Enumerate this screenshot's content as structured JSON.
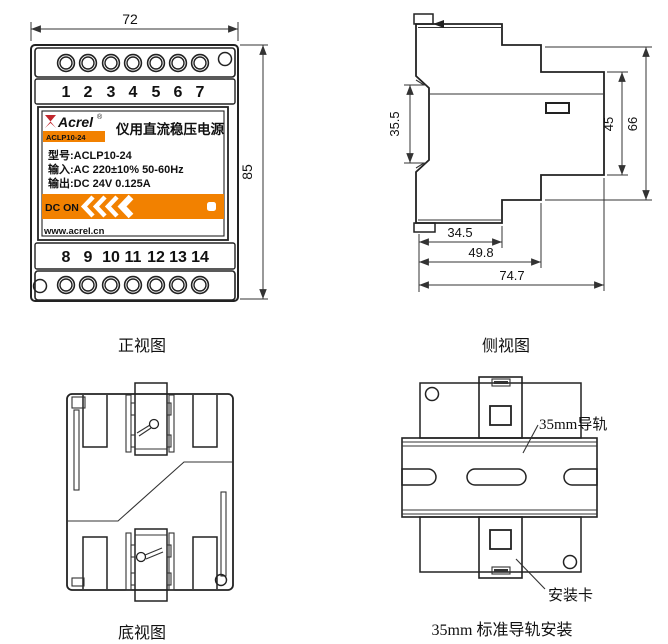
{
  "front": {
    "caption": "正视图",
    "dim_width": "72",
    "dim_height": "85",
    "terminals_top": [
      "1",
      "2",
      "3",
      "4",
      "5",
      "6",
      "7"
    ],
    "terminals_bottom": [
      "8",
      "9",
      "10",
      "11",
      "12",
      "13",
      "14"
    ],
    "label": {
      "brand": "Acrel",
      "reg_mark": "®",
      "model_badge": "ACLP10-24",
      "product_title": "仪用直流稳压电源",
      "spec_model": "型号:ACLP10-24",
      "spec_input": "输入:AC 220±10% 50-60Hz",
      "spec_output": "输出:DC 24V 0.125A",
      "dc_on": "DC ON",
      "website": "www.acrel.cn"
    }
  },
  "side": {
    "caption": "侧视图",
    "dims": {
      "clip_span": "35.5",
      "front_inner": "45",
      "front_outer": "66",
      "depth1": "34.5",
      "depth2": "49.8",
      "depth3": "74.7"
    }
  },
  "bottom": {
    "caption": "底视图"
  },
  "rail": {
    "caption": "35mm 标准导轨安装",
    "rail_label": "35mm导轨",
    "clip_label": "安装卡"
  },
  "colors": {
    "accent_orange": "#F28100",
    "brand_red": "#C1272D",
    "brand_text_red": "#9E2F26"
  }
}
